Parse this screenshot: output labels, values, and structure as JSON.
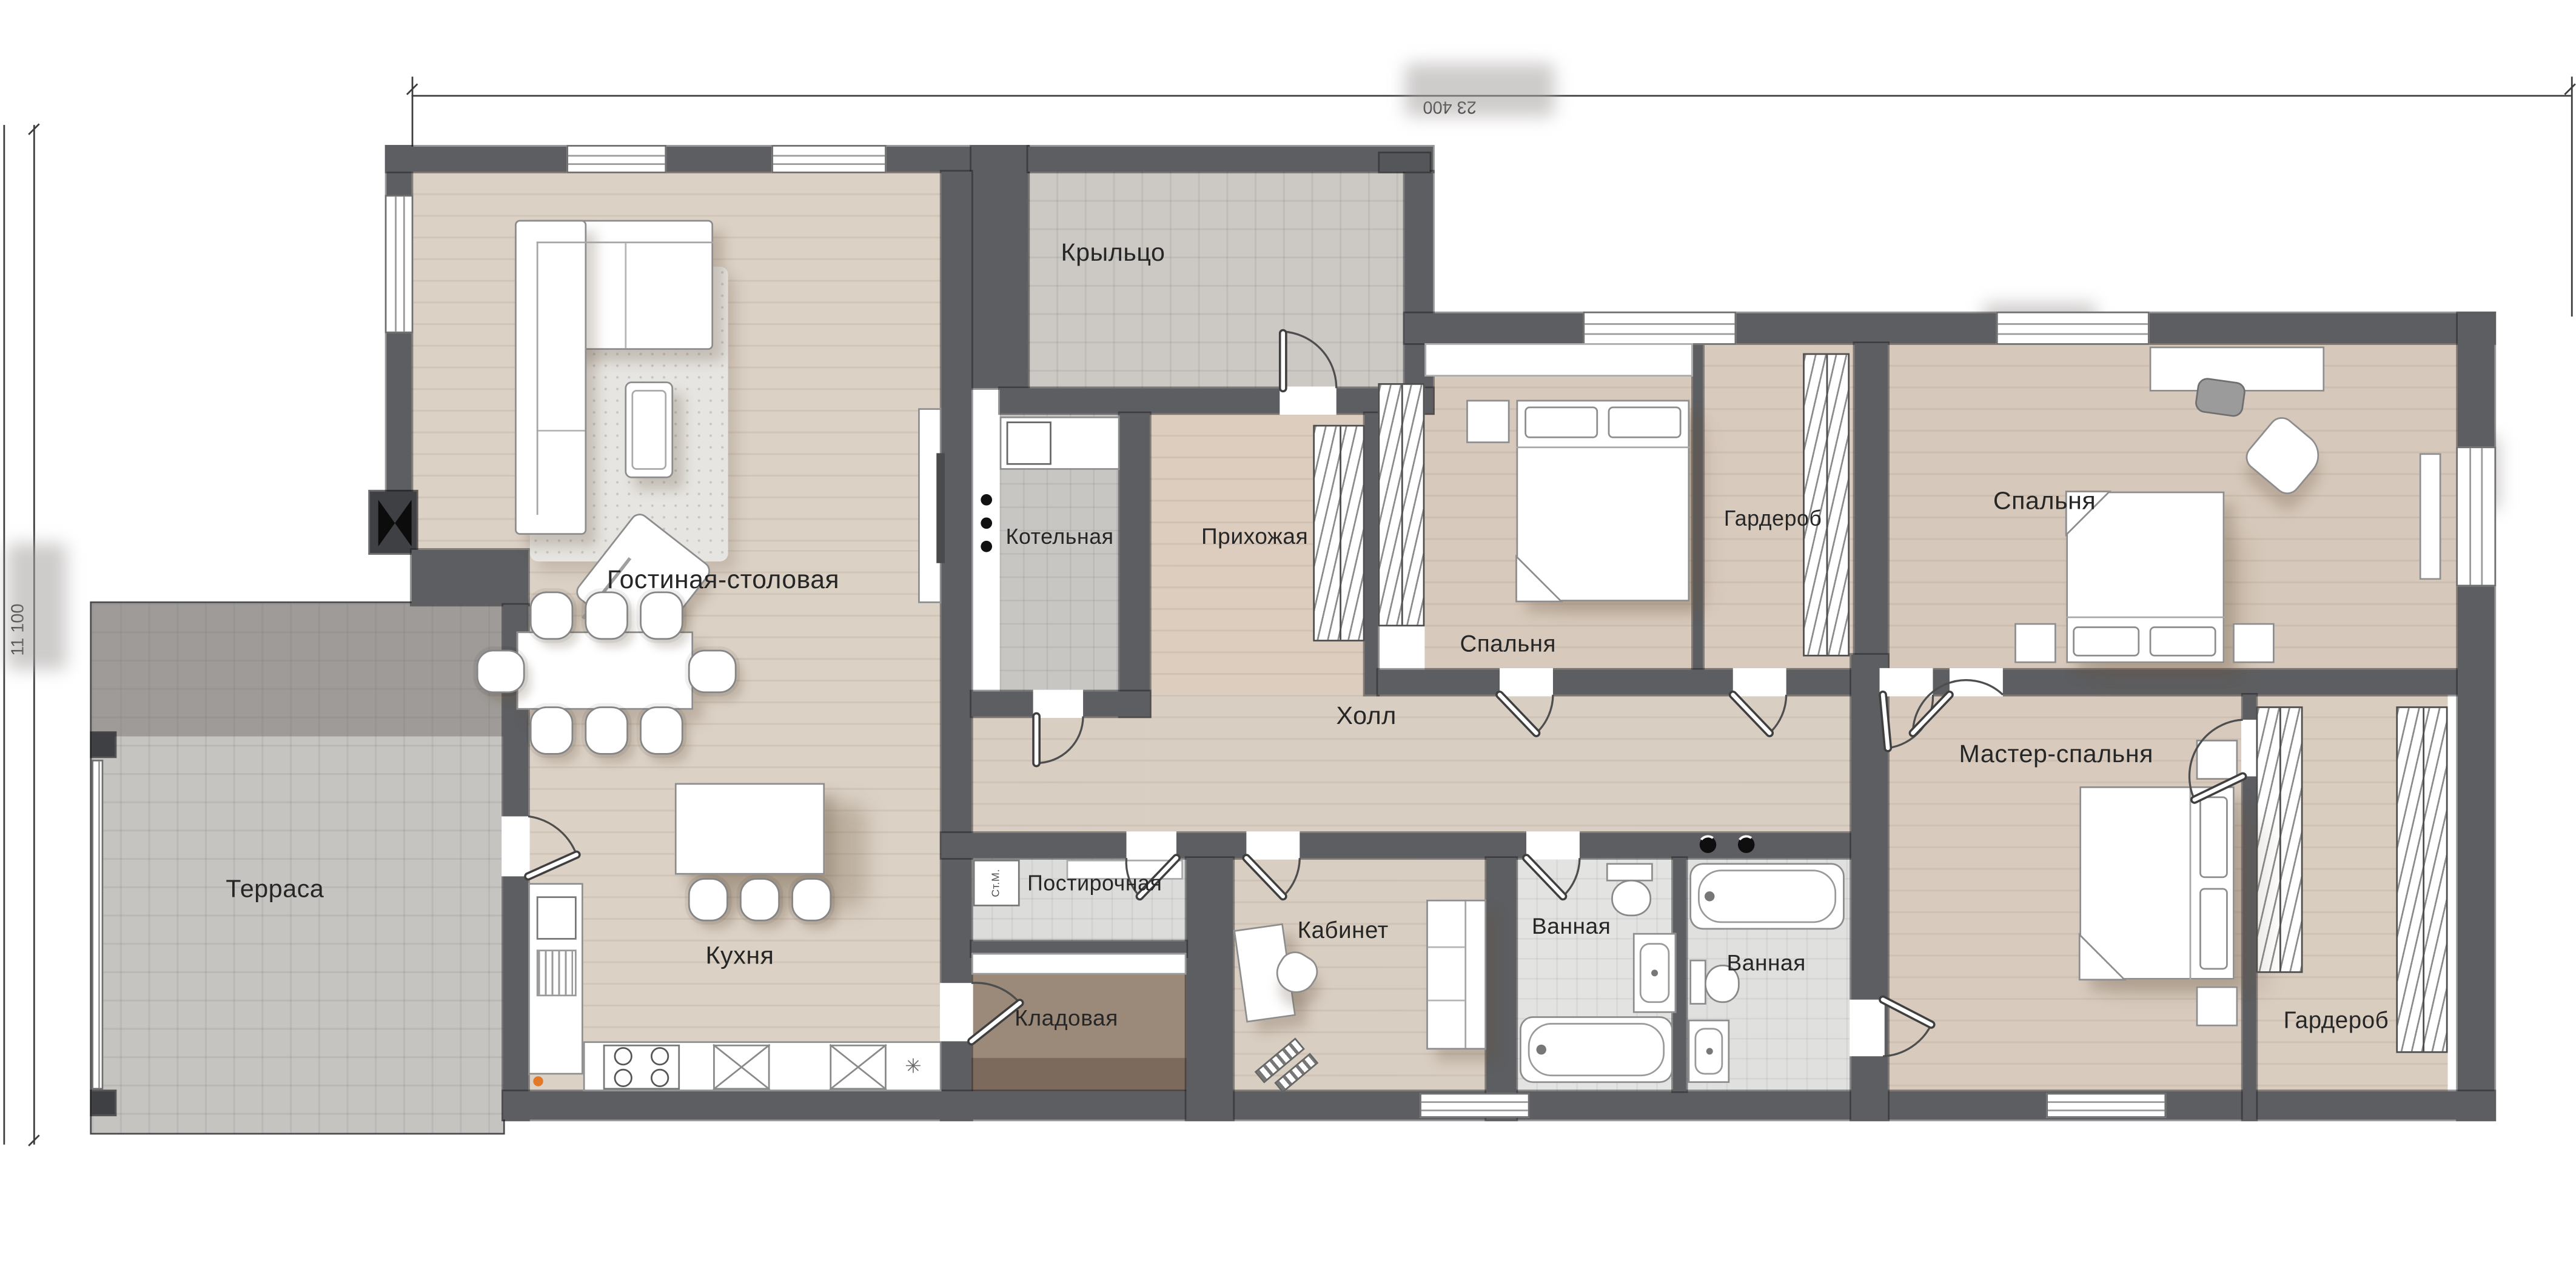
{
  "plan_title": "Одноэтажный дом — план",
  "dimensions": {
    "width_label": "23 400",
    "height_label": "11 100"
  },
  "rooms": [
    {
      "id": "terrace",
      "label": "Терраса"
    },
    {
      "id": "living_dining",
      "label": "Гостиная-столовая"
    },
    {
      "id": "kitchen",
      "label": "Кухня"
    },
    {
      "id": "porch",
      "label": "Крыльцо"
    },
    {
      "id": "boiler_room",
      "label": "Котельная"
    },
    {
      "id": "entry_hall",
      "label": "Прихожая"
    },
    {
      "id": "bedroom_1",
      "label": "Спальня"
    },
    {
      "id": "wardrobe_1",
      "label": "Гардероб"
    },
    {
      "id": "bedroom_2",
      "label": "Спальня"
    },
    {
      "id": "hall",
      "label": "Холл"
    },
    {
      "id": "master_bedroom",
      "label": "Мастер-спальня"
    },
    {
      "id": "wardrobe_2",
      "label": "Гардероб"
    },
    {
      "id": "laundry",
      "label": "Постирочная"
    },
    {
      "id": "pantry",
      "label": "Кладовая"
    },
    {
      "id": "office",
      "label": "Кабинет"
    },
    {
      "id": "bathroom_1",
      "label": "Ванная"
    },
    {
      "id": "bathroom_2",
      "label": "Ванная"
    }
  ],
  "appliances": {
    "washing_machine": "Ст.М."
  },
  "colors": {
    "wall": "#5d5e61",
    "wood_floor": "#d9cec2",
    "tile_floor": "#c9c7c3",
    "bath_tile": "#e3e3e2",
    "pantry_floor": "#9b8a7a",
    "label_text": "#262626"
  }
}
